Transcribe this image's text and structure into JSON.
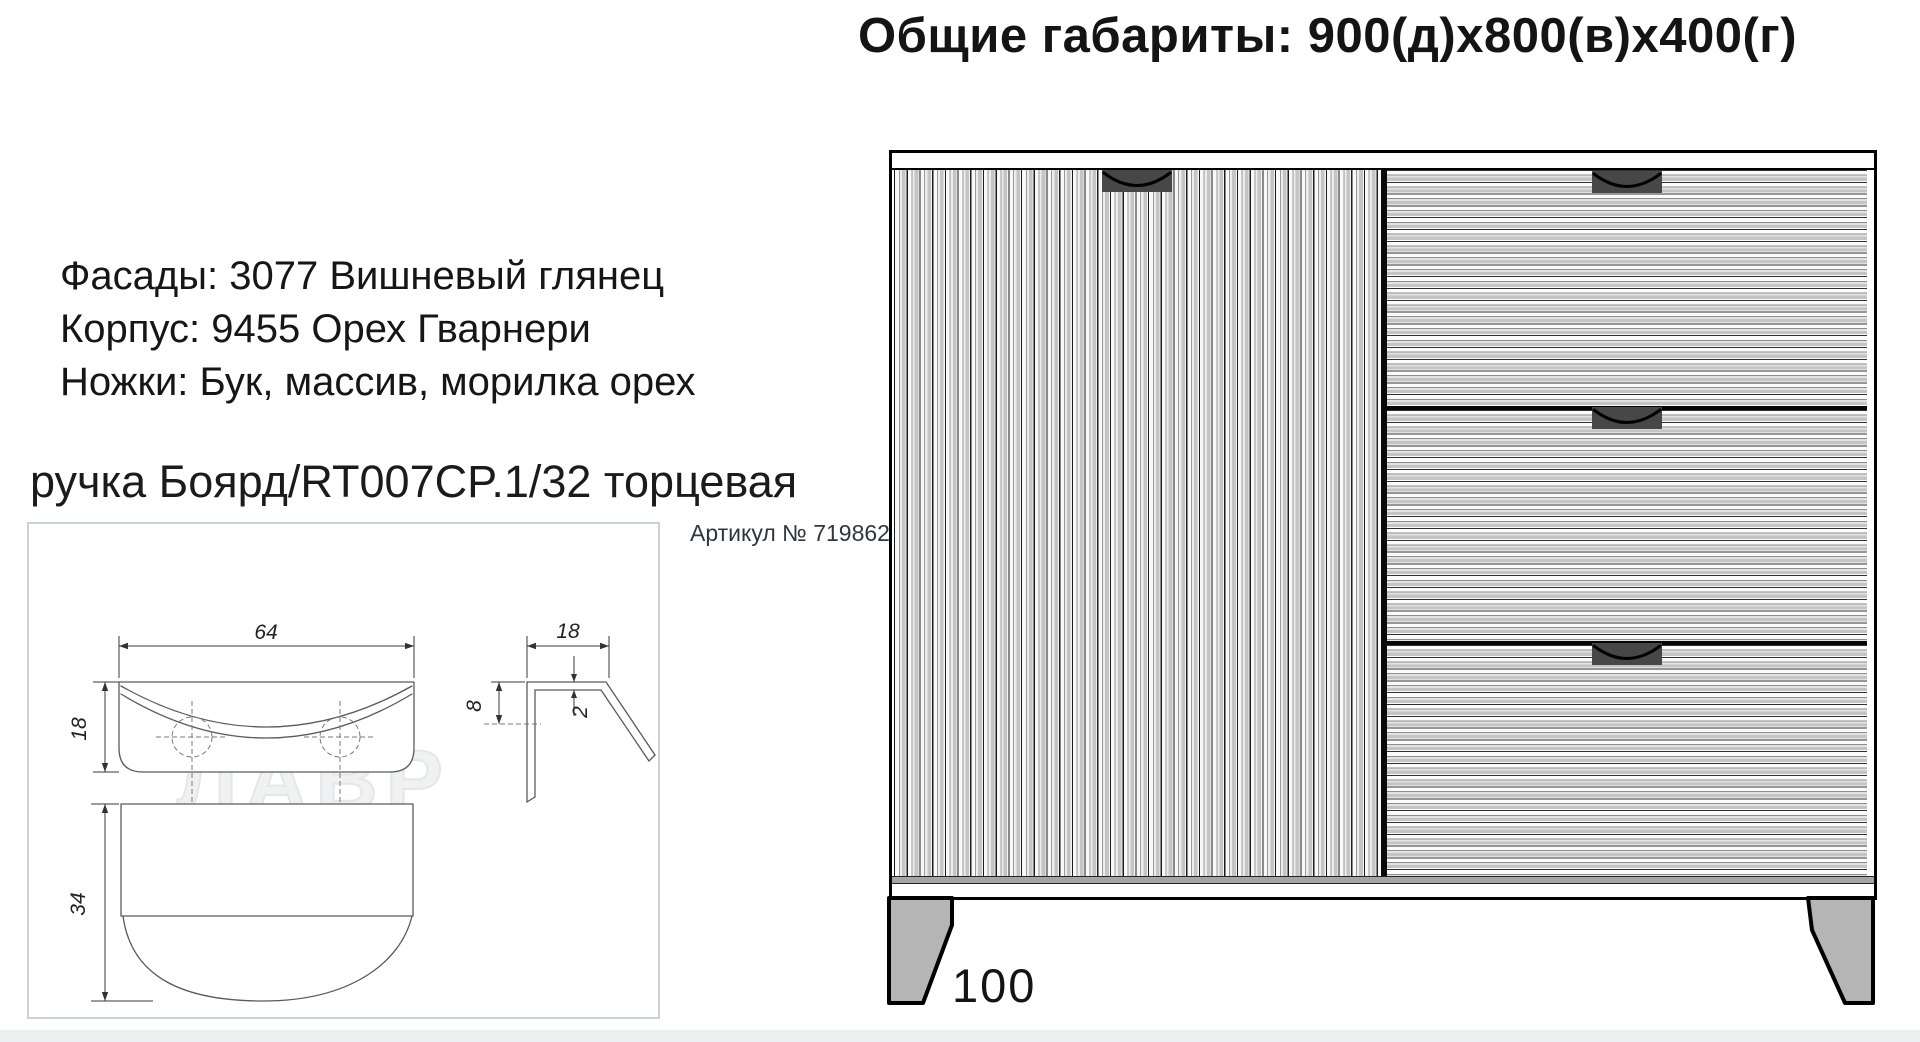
{
  "header": {
    "title": "Общие габариты: 900(д)x800(в)x400(г)"
  },
  "specs": {
    "facades": "Фасады: 3077 Вишневый глянец",
    "body": "Корпус: 9455 Орех Гварнери",
    "legs": "Ножки: Бук, массив, морилка орех"
  },
  "handle": {
    "title": "ручка Боярд/RT007CP.1/32 торцевая",
    "article": "Артикул № 719862",
    "watermark": "ЛАВР",
    "dims": {
      "front_width": "64",
      "front_height": "18",
      "hole_spacing": "32",
      "top_depth": "34",
      "side_width": "18",
      "side_hole_offset": "8",
      "thickness": "2"
    }
  },
  "cabinet": {
    "leg_height": "100"
  },
  "colors": {
    "box-border": "#c9d3d3",
    "leg-fill": "#b5b5b5",
    "handle-fill": "#474747",
    "stripe-gray": "#c4c4c4"
  }
}
